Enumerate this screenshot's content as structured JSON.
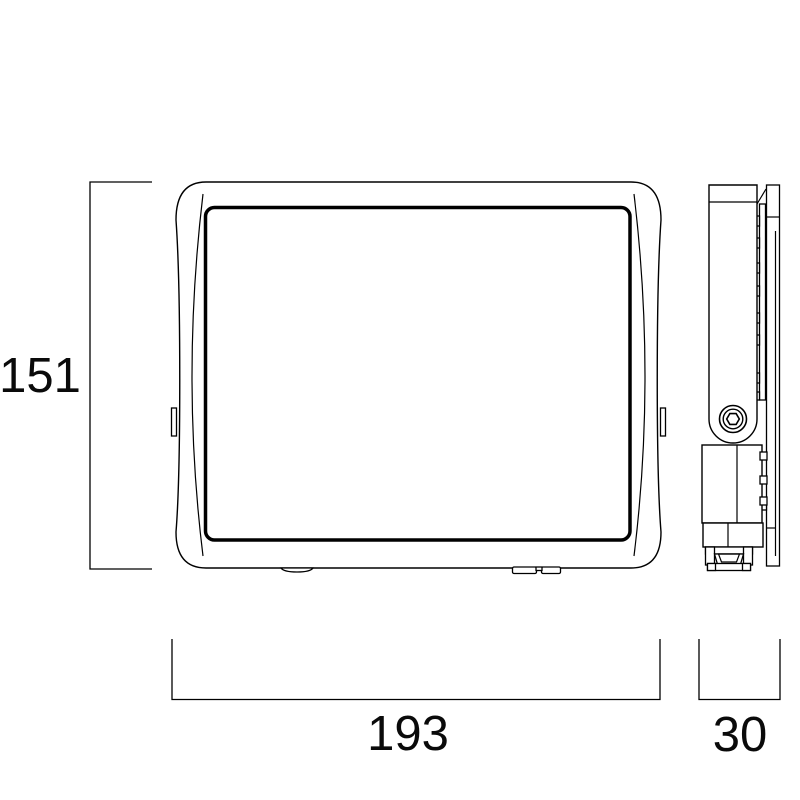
{
  "colors": {
    "background": "#ffffff",
    "line": "#000000",
    "text": "#0a0a0a"
  },
  "dimensions": {
    "height_mm": "151",
    "width_mm": "193",
    "depth_mm": "30"
  }
}
